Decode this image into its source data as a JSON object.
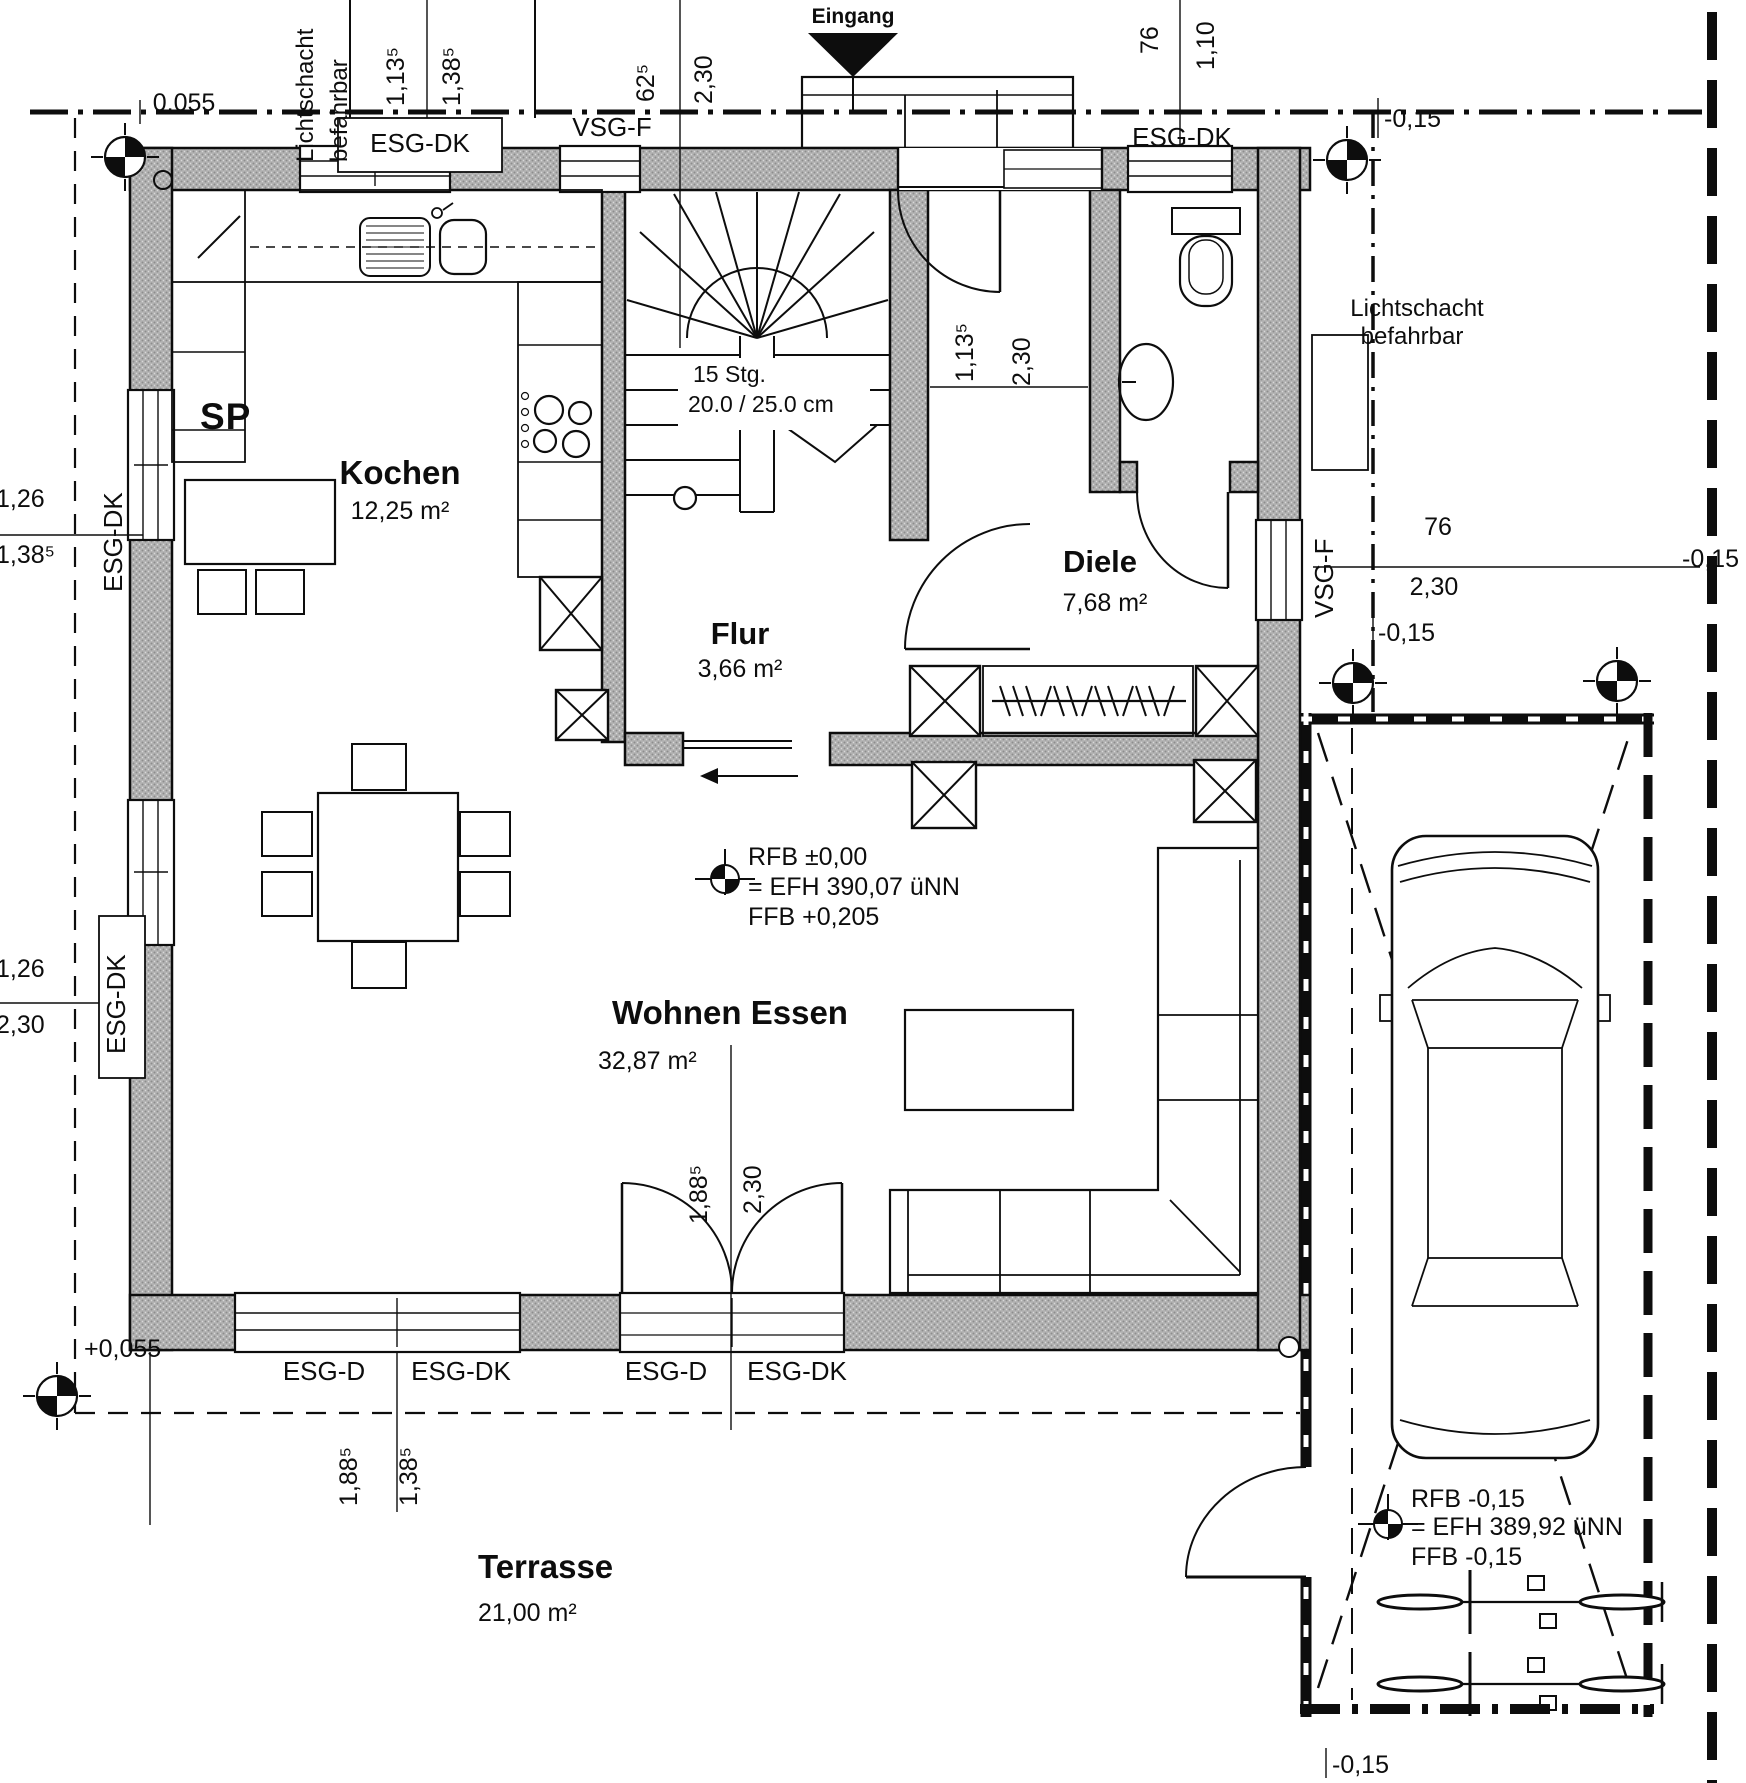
{
  "rooms": [
    {
      "name": "Kochen",
      "area": "12,25 m²"
    },
    {
      "name": "Flur",
      "area": "3,66 m²"
    },
    {
      "name": "Diele",
      "area": "7,68 m²"
    },
    {
      "name": "Wohnen Essen",
      "area": "32,87 m²"
    },
    {
      "name": "Terrasse",
      "area": "21,00 m²"
    }
  ],
  "windows": [
    "ESG-DK",
    "VSG-F",
    "ESG-DK",
    "ESG-DK",
    "ESG-DK",
    "VSG-F",
    "ESG-D",
    "ESG-DK",
    "ESG-D",
    "ESG-DK"
  ],
  "dims": [
    "0,055",
    "1,13⁵",
    "1,38⁵",
    "62⁵",
    "2,30",
    "76",
    "1,10",
    "-0,15",
    "1,26",
    "1,38⁵",
    "1,26",
    "2,30",
    "1,13⁵",
    "2,30",
    "76",
    "2,30",
    "-0,15",
    "-0,15",
    "1,88⁵",
    "2,30",
    "+0,055",
    "1,88⁵",
    "1,38⁵",
    "-0,15"
  ],
  "levels": {
    "house": {
      "l1": "RFB ±0,00",
      "l2": "= EFH 390,07 üNN",
      "l3": "FFB +0,205"
    },
    "garage": {
      "l1": "RFB -0,15",
      "l2": "= EFH 389,92 üNN",
      "l3": "FFB -0,15"
    }
  },
  "labels": {
    "eingang": "Eingang",
    "sp": "SP",
    "lichtschacht_line1": "Lichtschacht",
    "lichtschacht_line2": "befahrbar",
    "stairs_line1": "15 Stg.",
    "stairs_line2": "20.0 / 25.0 cm"
  },
  "colors": {
    "line": "#0d0d0d",
    "wall_fill": "#b3b3b3",
    "paper": "#ffffff"
  }
}
